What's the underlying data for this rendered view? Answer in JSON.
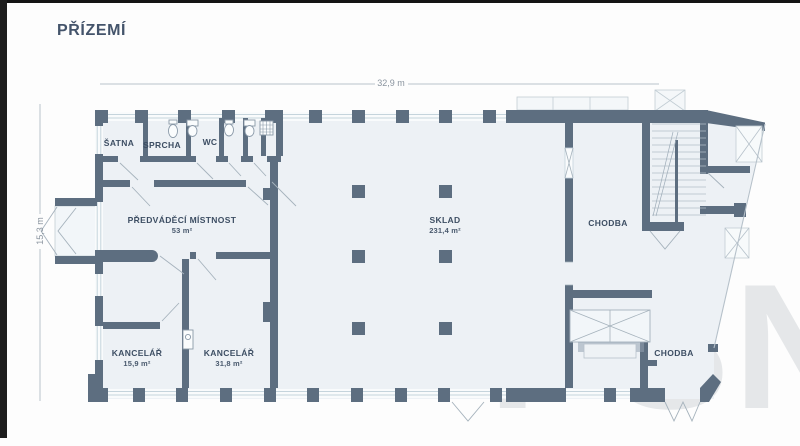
{
  "header": {
    "title": "PŘÍZEMÍ"
  },
  "dimensions": {
    "width_label": "32,9 m",
    "height_label": "15,3 m"
  },
  "rooms": {
    "satna": {
      "name": "ŠATNA"
    },
    "sprcha": {
      "name": "SPRCHA"
    },
    "wc": {
      "name": "WC"
    },
    "predvadeci": {
      "name": "PŘEDVÁDĚCÍ MÍSTNOST",
      "area": "53 m²"
    },
    "sklad": {
      "name": "SKLAD",
      "area": "231,4 m²"
    },
    "chodba_top": {
      "name": "CHODBA"
    },
    "kancelar_small": {
      "name": "KANCELÁŘ",
      "area": "15,9 m²"
    },
    "kancelar_large": {
      "name": "KANCELÁŘ",
      "area": "31,8 m²"
    },
    "chodba_bottom": {
      "name": "CHODBA"
    }
  },
  "watermark": {
    "text": "PSN"
  },
  "colors": {
    "wall": "#5d6e80",
    "room_fill": "#edf1f5",
    "window_line": "#c5d4dc",
    "title_text": "#44546b",
    "label_text": "#3d4e63",
    "dimension_text": "#8a949f",
    "watermark_text": "#b5bcc2"
  }
}
